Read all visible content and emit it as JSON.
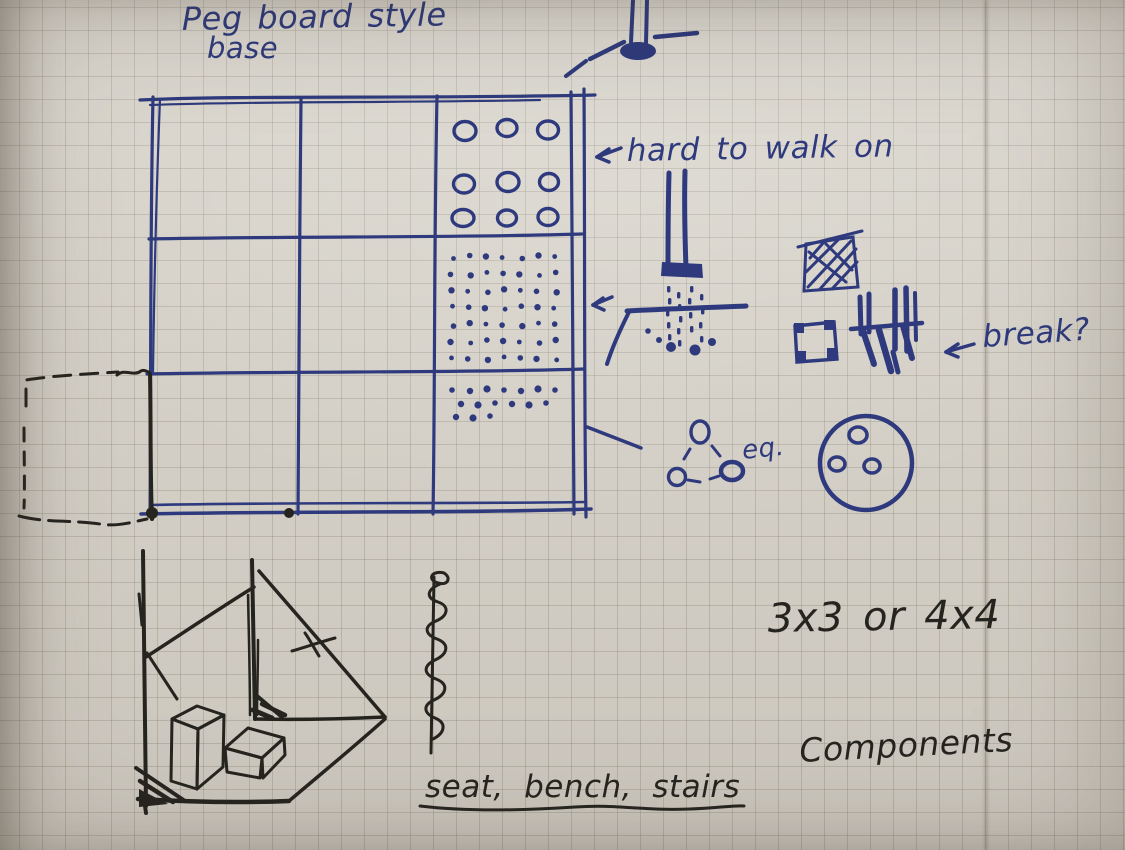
{
  "page": {
    "type": "handwritten-design-sketch-photo",
    "subject": "Peg board style base concept on graph paper"
  },
  "ink": {
    "blue": "#2e3a7d",
    "black": "#26241f"
  },
  "paper": {
    "base": "#d8d4cb",
    "grid_line": "#7d7667"
  },
  "labels": {
    "title_line1": "Peg board style",
    "title_line2": "base",
    "annotation_hard_to_walk": "hard to walk on",
    "annotation_break": "break?",
    "annotation_eq": "eq.",
    "annotation_grid_size": "3x3 or 4x4",
    "annotation_components": "Components",
    "annotation_component_list": "seat, bench, stairs"
  },
  "sketch_elements": [
    {
      "name": "pegboard-grid-plan",
      "label": "3x3 base grid with peg-hole patterns"
    },
    {
      "name": "peg-cross-section",
      "label": "peg socket side view"
    },
    {
      "name": "peg-into-holes",
      "label": "peg legs dropping into board holes"
    },
    {
      "name": "hatched-pad",
      "label": "hatched square pad"
    },
    {
      "name": "base-plate-corner-holes",
      "label": "plate with corner holes"
    },
    {
      "name": "legs-that-break",
      "label": "thin legs detail"
    },
    {
      "name": "three-peg-triangle",
      "label": "three pegs, triangular layout"
    },
    {
      "name": "round-base-three-holes",
      "label": "round base with three holes"
    },
    {
      "name": "corner-room-perspective",
      "label": "corner perspective with seat and bench"
    },
    {
      "name": "spiral-screw",
      "label": "screw spiral pole"
    },
    {
      "name": "dashed-grid-extension",
      "label": "dashed extension of base grid"
    }
  ]
}
